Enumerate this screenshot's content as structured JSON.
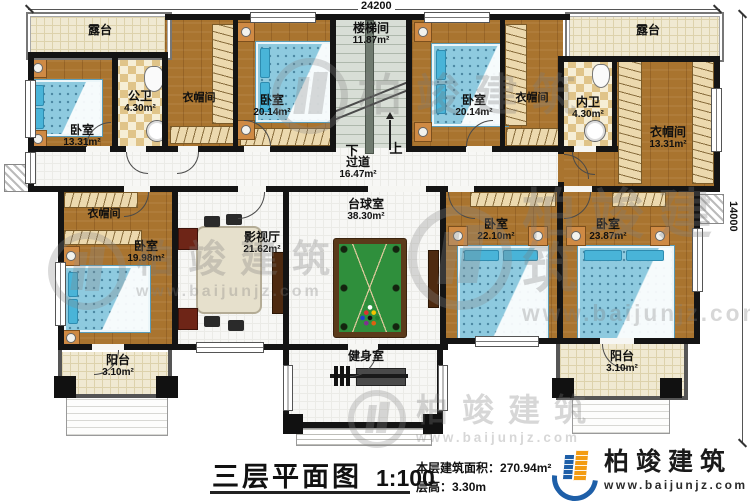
{
  "dims": {
    "width": "24200",
    "height": "14000"
  },
  "stairs": {
    "down": "下",
    "up": "上"
  },
  "rooms": {
    "terrace_left": {
      "name": "露台"
    },
    "terrace_right": {
      "name": "露台"
    },
    "bedroom_13": {
      "name": "卧室",
      "area": "13.31m²"
    },
    "public_bath": {
      "name": "公卫",
      "area": "4.30m²"
    },
    "closet_top_left": {
      "name": "衣帽间"
    },
    "bedroom_20_left": {
      "name": "卧室",
      "area": "20.14m²"
    },
    "stairwell": {
      "name": "楼梯间",
      "area": "11.87m²"
    },
    "bedroom_20_right": {
      "name": "卧室",
      "area": "20.14m²"
    },
    "closet_top_right": {
      "name": "衣帽间"
    },
    "private_bath": {
      "name": "内卫",
      "area": "4.30m²"
    },
    "closet_right": {
      "name": "衣帽间",
      "area": "13.31m²"
    },
    "hallway": {
      "name": "过道",
      "area": "16.47m²"
    },
    "closet_left": {
      "name": "衣帽间"
    },
    "bedroom_19": {
      "name": "卧室",
      "area": "19.98m²"
    },
    "media_room": {
      "name": "影视厅",
      "area": "21.62m²"
    },
    "billiard_room": {
      "name": "台球室",
      "area": "38.30m²"
    },
    "bedroom_22": {
      "name": "卧室",
      "area": "22.10m²"
    },
    "bedroom_23": {
      "name": "卧室",
      "area": "23.87m²"
    },
    "balcony_left": {
      "name": "阳台",
      "area": "3.10m²"
    },
    "gym": {
      "name": "健身室"
    },
    "balcony_right": {
      "name": "阳台",
      "area": "3.10m²"
    }
  },
  "titlebar": {
    "title": "三层平面图",
    "scale": "1:100",
    "area_label": "本层建筑面积：",
    "area_value": "270.94m²",
    "floor_height_label": "层高：",
    "floor_height_value": "3.30m"
  },
  "brand": {
    "company": "柏竣建筑",
    "website": "www.baijunjz.com"
  },
  "watermark": {
    "text": "柏竣建筑",
    "site": "www.baijunjz.com"
  },
  "colors": {
    "wall": "#141414",
    "wood_floor": "#a9742f",
    "bed": "#8ecadf",
    "terrace": "#f0e9d2",
    "pool_felt": "#2f8f3c",
    "logo_blue": "#1e5fa8",
    "logo_orange": "#f39c12"
  }
}
